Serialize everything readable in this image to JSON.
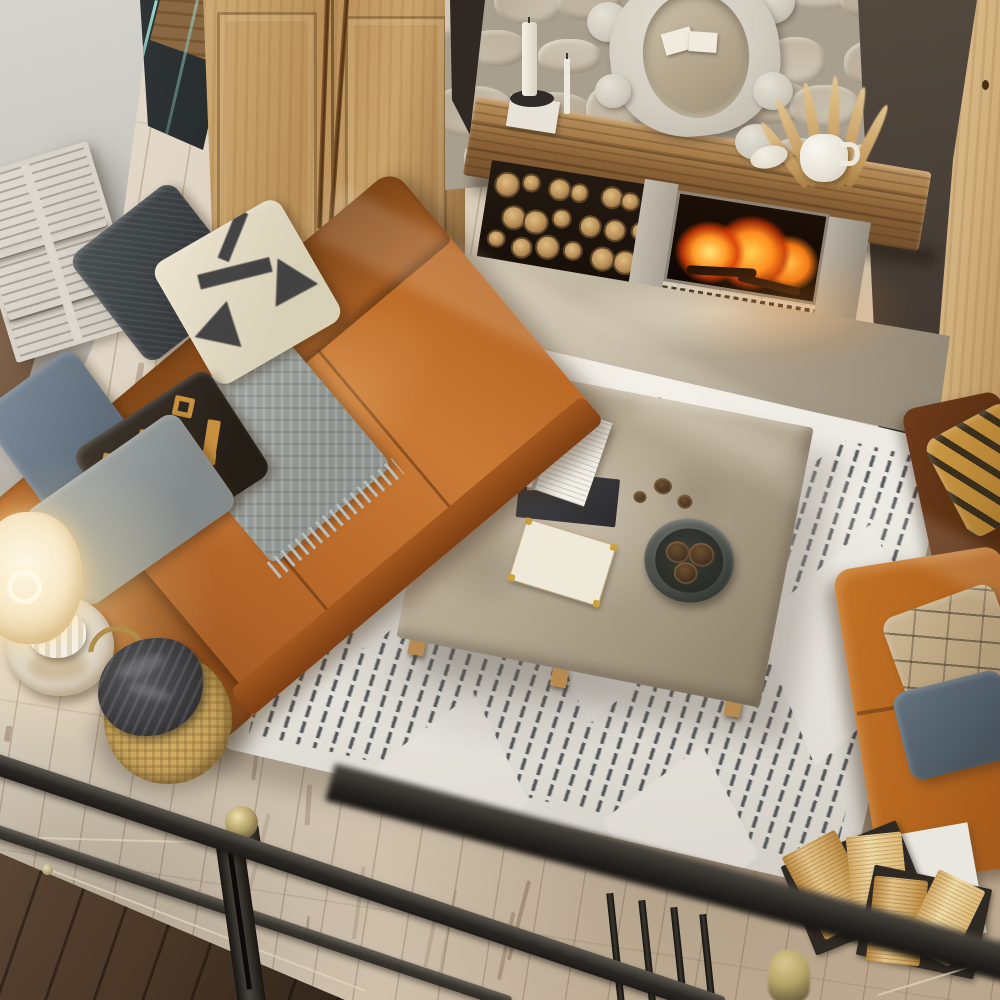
{
  "scene": {
    "title": "Top-down view of a rustic living room with stone fireplace, leather sofas and diamond shag rug",
    "palette": {
      "leather": "#b5661f",
      "leather_dark": "#6e3b1b",
      "rug_white": "#edeae3",
      "rug_stripe": "#4b5053",
      "wardrobe_wood": "#c7a26c",
      "cabinet_wood": "#d6b885",
      "floor_whitewash": "#d8ccba",
      "stone_wall": "#c5bbaa",
      "mantel_wood": "#93683d",
      "fire_orange": "#ff8c2a",
      "accent_wall": "#453e38",
      "railing_metal": "#2e2b27",
      "brass": "#b5a468",
      "basket_straw": "#c3a05a",
      "lamp_glow": "#ffe9c0",
      "concrete_table": "#a99b85"
    },
    "objects": {
      "floor": {
        "label": "Whitewashed distressed plank floor"
      },
      "wall_left": {
        "label": "White plaster wall"
      },
      "glass_door": {
        "label": "Glass door with dark frame"
      },
      "shutters": {
        "label": "White louvered shutter panel"
      },
      "wardrobe": {
        "label": "Oak double-door wardrobe with long brass pulls"
      },
      "stone_wall": {
        "label": "Beige stone chimney wall"
      },
      "dark_wall": {
        "label": "Charcoal accent wall"
      },
      "cabinet": {
        "label": "Tall pine cabinet"
      },
      "mirror": {
        "label": "Carved white cartouche mirror"
      },
      "mirror_reflection": {
        "label": "Open book reflected in mirror"
      },
      "mantel": {
        "label": "Reclaimed timber mantel beam"
      },
      "candles": {
        "label": "White pillar candles on black stand"
      },
      "pampas": {
        "label": "White pitcher with dried pampas stems"
      },
      "shell": {
        "label": "White shell ornament"
      },
      "firewood": {
        "label": "Stacked firewood in niche"
      },
      "fireplace": {
        "label": "Fireplace insert with burning fire"
      },
      "hearth": {
        "label": "Rough stone hearth slab"
      },
      "rug": {
        "label": "White shag rug with charcoal diamond stripe pattern"
      },
      "coffee_table": {
        "label": "Square concrete coffee table"
      },
      "open_book": {
        "label": "Open paperback book"
      },
      "notebook": {
        "label": "Black notebook"
      },
      "keepsake_box": {
        "label": "Cream keepsake box with brass corners"
      },
      "bowl": {
        "label": "Stone bowl filled with pinecones"
      },
      "pinecones": {
        "label": "Loose pinecones"
      },
      "sofa_left": {
        "label": "Cognac leather sofa"
      },
      "pillow_charcoal": {
        "label": "Charcoal tweed pillow"
      },
      "pillow_tribal": {
        "label": "Cream pillow with black tribal motif"
      },
      "pillow_blue": {
        "label": "Slate blue pillow"
      },
      "pillow_kilim": {
        "label": "Dark kilim pillow with gold motifs"
      },
      "pillow_gray": {
        "label": "Light gray pillow"
      },
      "throw": {
        "label": "Gray knit throw with fringe"
      },
      "lamp": {
        "label": "Glowing cream table lamp"
      },
      "side_table": {
        "label": "Distressed white pedestal side table"
      },
      "gold_ring": {
        "label": "Small brass ring on floor"
      },
      "basket": {
        "label": "Seagrass basket with charcoal blanket"
      },
      "sofa_right": {
        "label": "Second leather sofa"
      },
      "pillow_gold": {
        "label": "Gold kilim pillow with black slashes"
      },
      "pillow_tan": {
        "label": "Tan pillow with dark line pattern"
      },
      "pillow_blue2": {
        "label": "Blue-gray chenille pillow"
      },
      "floor_books": {
        "label": "Open books lying on the rug corner"
      },
      "stairs": {
        "label": "Dark wood stair treads"
      },
      "railing": {
        "label": "Black metal loft railing"
      },
      "finial": {
        "label": "Brass ball finial"
      },
      "post_cap": {
        "label": "Brass post cap"
      },
      "cables": {
        "label": "Steel tension cables"
      },
      "sunlight": {
        "label": "Sunlight streaks"
      }
    }
  }
}
